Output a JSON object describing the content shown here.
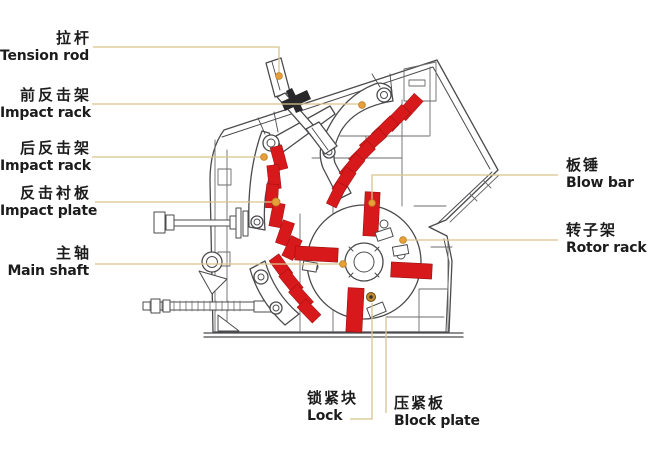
{
  "diagram": {
    "description": "Impact crusher cross-section part diagram",
    "labels": {
      "tension_rod": {
        "zh": "拉杆",
        "en": "Tension rod"
      },
      "front_impact_rack": {
        "zh": "前反击架",
        "en": "Impact rack"
      },
      "rear_impact_rack": {
        "zh": "后反击架",
        "en": "Impact rack"
      },
      "impact_plate": {
        "zh": "反击衬板",
        "en": "Impact plate"
      },
      "main_shaft": {
        "zh": "主轴",
        "en": "Main shaft"
      },
      "blow_bar": {
        "zh": "板锤",
        "en": "Blow bar"
      },
      "rotor_rack": {
        "zh": "转子架",
        "en": "Rotor rack"
      },
      "lock": {
        "zh": "锁紧块",
        "en": "Lock"
      },
      "block_plate": {
        "zh": "压紧板",
        "en": "Block plate"
      }
    },
    "colors": {
      "highlight_red": "#d8191b",
      "leader_line": "#d9c48c",
      "marker_dot": "#e79f3a",
      "outline_gray": "#4b4b4e",
      "lock_gold": "#c08a2e"
    }
  }
}
